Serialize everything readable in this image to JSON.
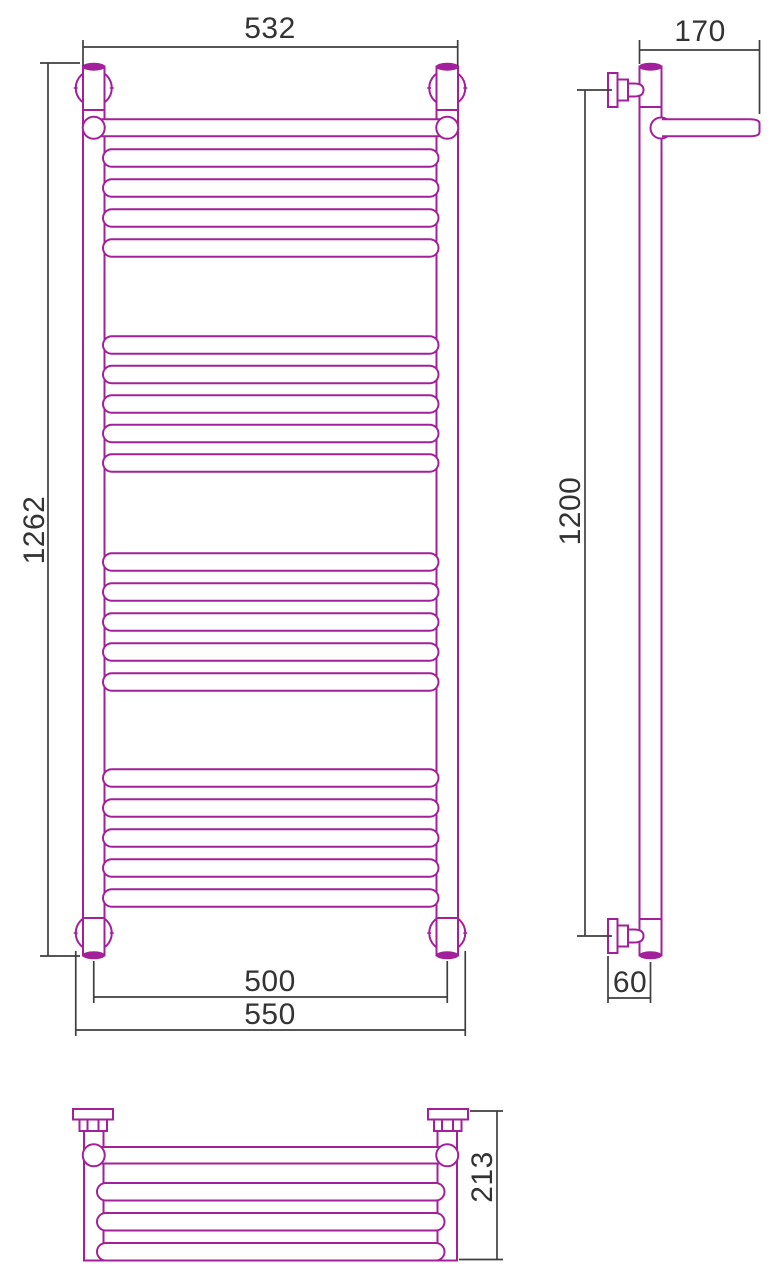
{
  "colors": {
    "pipe_outline": "#A2209A",
    "dimension_lines": "#3F3F3F",
    "dimension_text": "#333333",
    "background": "#FFFFFF"
  },
  "dims": {
    "front_top_width": "532",
    "front_height": "1262",
    "front_axis_width": "500",
    "front_overall_width": "550",
    "side_top_depth": "170",
    "side_axis_height": "1200",
    "side_wall_to_axis": "60",
    "top_depth": "213"
  },
  "geometry": {
    "front_rail_centers": [
      158,
      188,
      218,
      248,
      345,
      374.5,
      404,
      433.5,
      463,
      562,
      592,
      622,
      652,
      682,
      778,
      808,
      838,
      868,
      898
    ],
    "front_rail": {
      "x": 103,
      "width": 335.5,
      "height": 17.5
    },
    "top_rail_centers": [
      1191.75,
      1221.75,
      1251.75
    ],
    "top_rail": {
      "x": 97,
      "width": 347.5,
      "height": 17.5
    }
  }
}
